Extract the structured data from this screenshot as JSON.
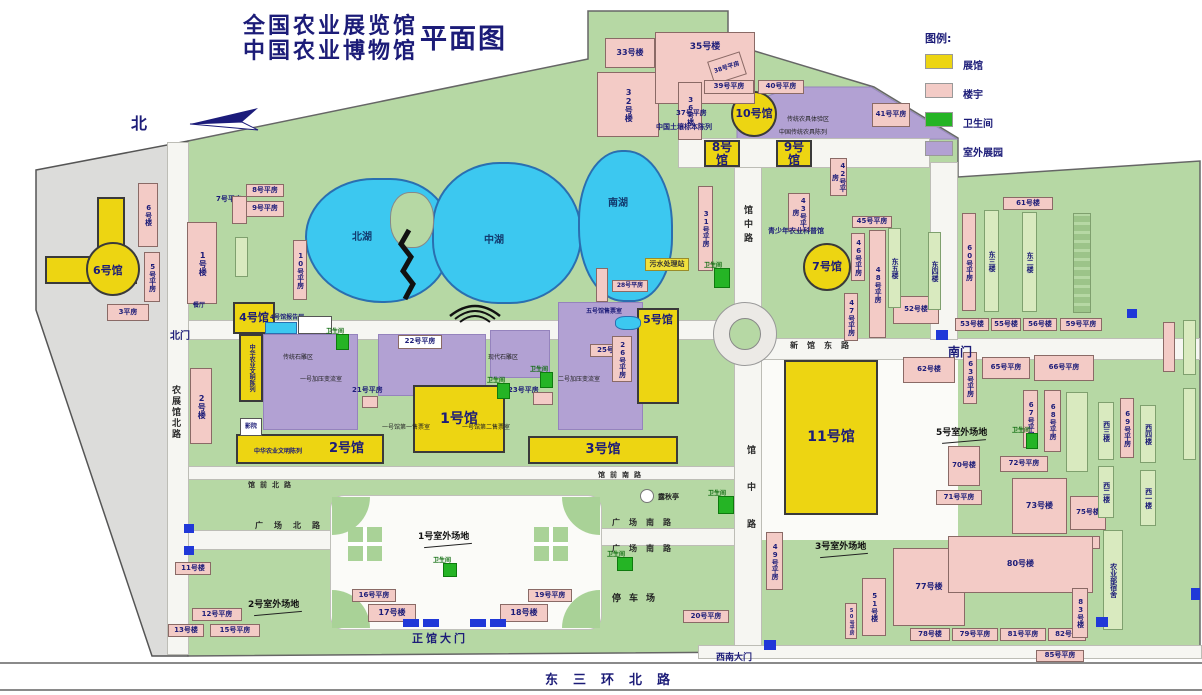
{
  "title": {
    "line1": "全国农业展览馆",
    "line2": "中国农业博物馆",
    "type_label": "平面图"
  },
  "compass": {
    "north": "北"
  },
  "legend": {
    "heading": "图例:",
    "items": [
      {
        "label": "展馆",
        "color": "#EDD512"
      },
      {
        "label": "楼宇",
        "color": "#F3CBC6"
      },
      {
        "label": "卫生间",
        "color": "#25B425"
      },
      {
        "label": "室外展园",
        "color": "#B2A1D3"
      }
    ]
  },
  "lakes": {
    "north": "北湖",
    "middle": "中湖",
    "south": "南湖"
  },
  "halls": {
    "h1": "1号馆",
    "h2": "2号馆",
    "h3": "3号馆",
    "h4": "4号馆",
    "h5": "5号馆",
    "h6": "6号馆",
    "h7": "7号馆",
    "h8": "8号馆",
    "h9": "9号馆",
    "h10": "10号馆",
    "h11": "11号馆"
  },
  "roads": {
    "dongsanhuanbeilu": "东三环北路",
    "nongzhanguanbeilu": "农展馆北路",
    "guanzhonglu_upper": "馆中路",
    "guanzhonglu_lower": "馆中路",
    "guangchangbeilu": "广场北路",
    "guangchangnanlu_1": "广场南路",
    "guangchangnanlu_2": "广场南路",
    "guanqianbeilu": "馆前北路",
    "guanqiannanlu": "馆前南路",
    "xinguandonglu": "新馆东路"
  },
  "gates": {
    "north": "北门",
    "south": "南门",
    "main": "正馆大门",
    "southwest": "西南大门"
  },
  "grounds": {
    "g1": "1号室外场地",
    "g2": "2号室外场地",
    "g3": "3号室外场地",
    "g5": "5号室外场地",
    "parking": "停车场"
  },
  "facilities": {
    "toilet": "卫生间",
    "sewage": "污水处理站",
    "pavilion": "露秋亭",
    "canteen": "餐厅",
    "cinema": "影院",
    "report_hall": "4号馆报告厅",
    "ticket_hall1_1": "一号馆第一售票室",
    "ticket_hall1_2": "一号馆第二售票室",
    "ticket_hall5": "五号馆售票室"
  },
  "areas": {
    "tools_experience": "传统农具体验区",
    "tools_display": "中国传统农具陈列",
    "stone_traditional": "传统石雕区",
    "stone_modern": "现代石雕区",
    "pump1": "一号加压变流室",
    "pump2": "二号加压变流室",
    "soil_display": "中国土壤标本陈列",
    "youth_science": "青少年农业科普馆",
    "civilization_h4": "中华农业文明陈列",
    "civilization_h2": "中华农业文明陈列",
    "moa_dorm": "农业部宿舍"
  },
  "buildings": {
    "lou1": "1号楼",
    "lou2": "2号楼",
    "ph3": "3平房",
    "ph5": "5号平房",
    "lou6": "6号楼",
    "ph7": "7号平房",
    "ph8": "8号平房",
    "ph9": "9号平房",
    "ph10": "10号平房",
    "lou11": "11号楼",
    "ph12": "12号平房",
    "lou13": "13号楼",
    "ph15": "15号平房",
    "ph16": "16号平房",
    "lou17": "17号楼",
    "lou18": "18号楼",
    "ph19": "19号平房",
    "ph20": "20号平房",
    "ph21": "21号平房",
    "ph22": "22号平房",
    "ph23": "23号平房",
    "lou25": "25号楼",
    "ph26": "26号平房",
    "ph28": "28号平房",
    "ph31": "31号平房",
    "lou32": "32号楼",
    "lou33": "33号楼",
    "lou35": "35号楼",
    "lou36": "36号楼",
    "ph37": "37号平房",
    "ph38": "38号平房",
    "ph39": "39号平房",
    "ph40": "40号平房",
    "ph41": "41号平房",
    "ph42": "42号平房",
    "ph43": "43号平房",
    "ph45": "45号平房",
    "ph46": "46号平房",
    "ph47": "47号平房",
    "ph48": "48号平房",
    "ph49": "49号平房",
    "ph50": "50号平房",
    "lou51": "51号楼",
    "lou52": "52号楼",
    "lou53": "53号楼",
    "lou55": "55号楼",
    "lou56": "56号楼",
    "ph59": "59号平房",
    "ph60": "60号平房",
    "lou61": "61号楼",
    "lou62": "62号楼",
    "ph63": "63号平房",
    "ph65": "65号平房",
    "ph66": "66号平房",
    "ph67": "67号平房",
    "ph68": "68号平房",
    "ph69": "69号平房",
    "lou70": "70号楼",
    "ph71": "71号平房",
    "ph72": "72号平房",
    "lou73": "73号楼",
    "lou75": "75号楼",
    "ph76": "76号平房",
    "lou77": "77号楼",
    "lou78": "78号楼",
    "ph79": "79号平房",
    "lou80": "80号楼",
    "ph81": "81号平房",
    "lou82": "82号楼",
    "lou83": "83号楼",
    "ph85": "85号平房",
    "dong5": "东五楼",
    "dong4": "东四楼",
    "dong3": "东三楼",
    "dong2": "东二楼",
    "xi3": "西三楼",
    "xi4": "西四楼",
    "xi2": "西二楼",
    "xi1": "西一楼"
  }
}
